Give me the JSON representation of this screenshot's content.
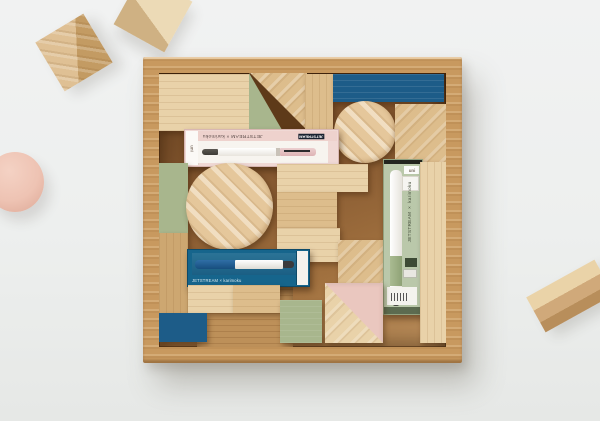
{
  "scene": {
    "type": "product-photo",
    "subject": "Wooden toy blocks in an oak tray with uni JETSTREAM x karimoku ballpoint pen packages mixed among the blocks"
  },
  "colors": {
    "bg": "#eef0ef",
    "frame": "#c8995f",
    "frame_dark": "#9a7342",
    "floor": "#8a5c2e",
    "floor_light": "#bd9059",
    "wood_light": "#e9d2a9",
    "wood_mid": "#ddbd8c",
    "wood_deep": "#cda771",
    "blue": "#1d5c88",
    "teal": "#16658c",
    "green": "#a8b68d",
    "sage": "#bac8aa",
    "pink": "#eac7bf",
    "pink_pkg": "#f0d9d5"
  },
  "packages": {
    "pink": {
      "brand": "uni",
      "title": "JETSTREAM × karimoku",
      "logo": "JETSTREAM"
    },
    "blue": {
      "title": "JETSTREAM × karimoku"
    },
    "green": {
      "brand": "uni",
      "title": "JETSTREAM × karimoku"
    }
  }
}
